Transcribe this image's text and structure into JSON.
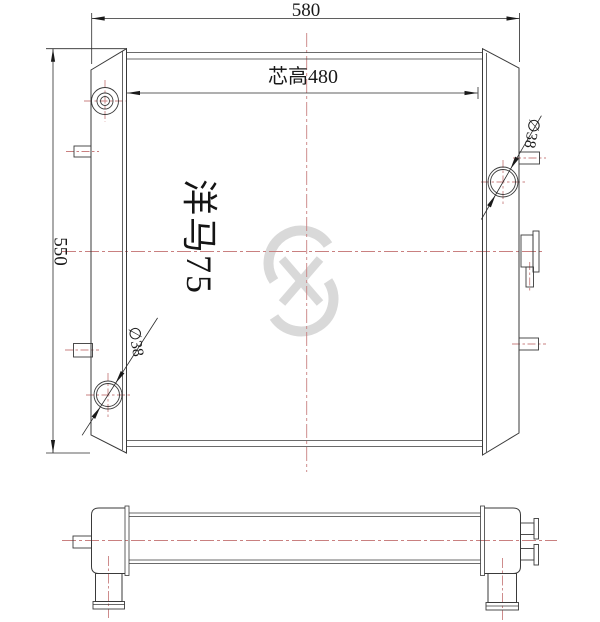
{
  "drawing": {
    "model_label": "洋马75",
    "dimensions": {
      "overall_width": "580",
      "core_height": "芯高480",
      "overall_height": "550",
      "inlet_diameter": "∅38",
      "outlet_diameter": "∅38"
    },
    "watermark_icon": "s-swoosh-logo",
    "colors": {
      "line": "#3a3a3a",
      "centerline": "#c98080",
      "watermark": "#d9d9d9",
      "background": "#ffffff"
    }
  }
}
